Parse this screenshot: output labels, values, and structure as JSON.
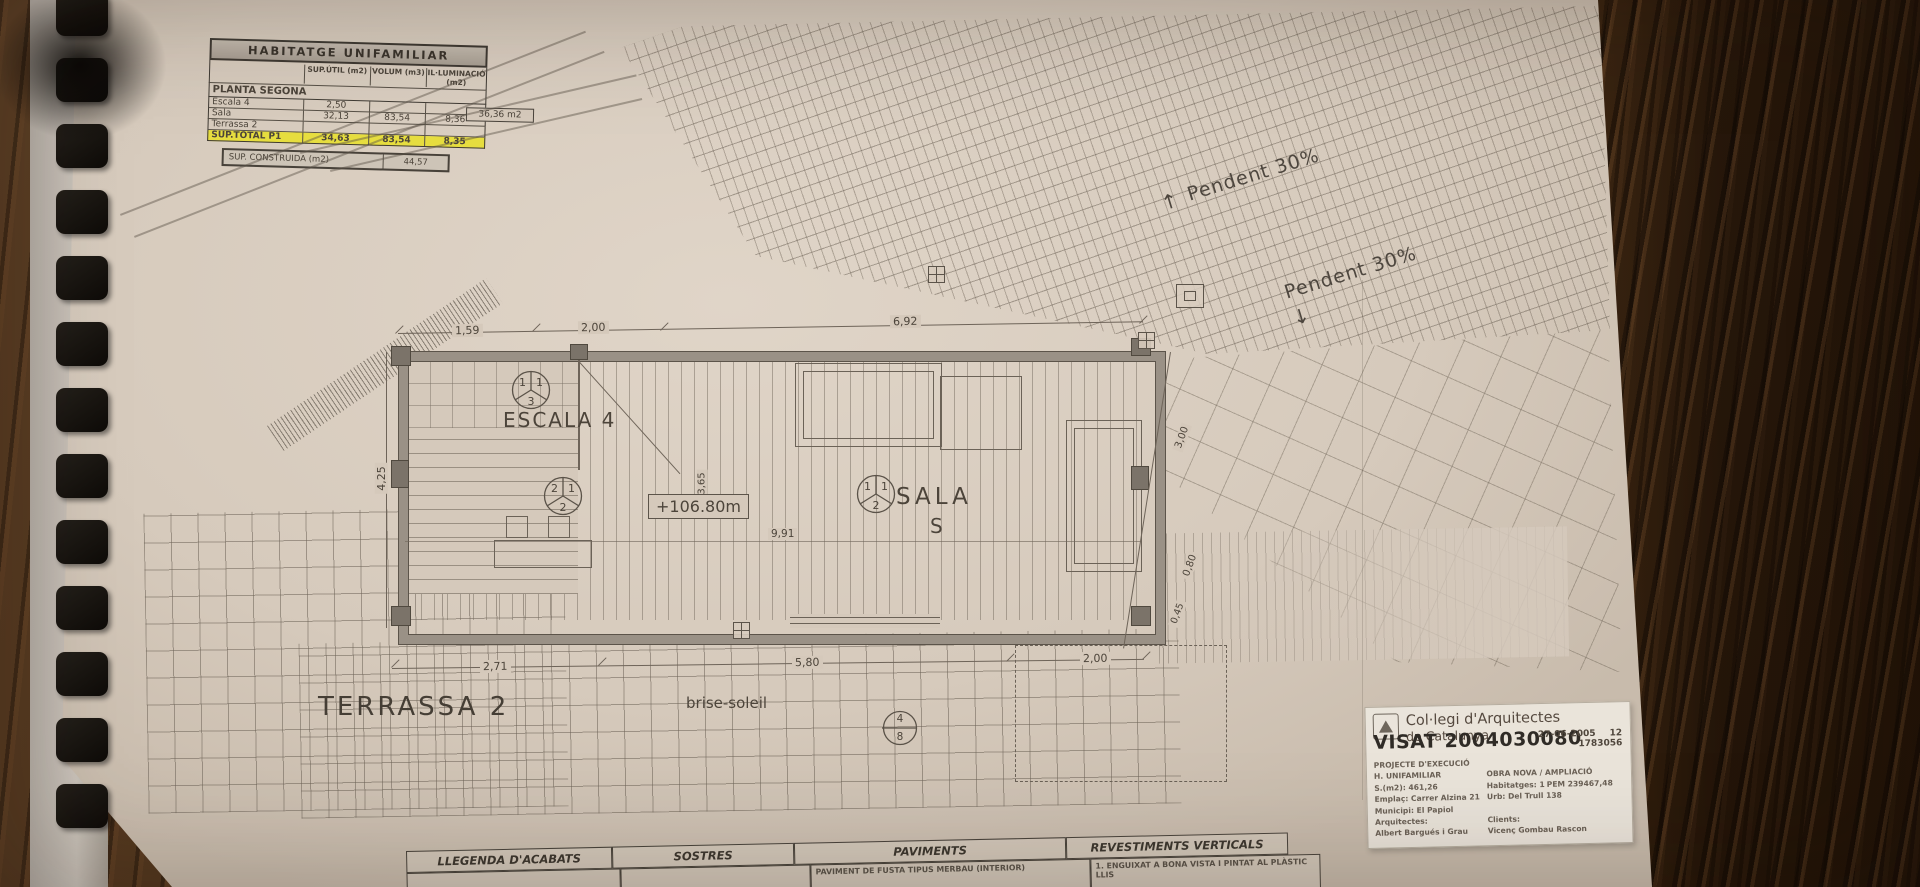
{
  "area_table": {
    "title": "HABITATGE UNIFAMILIAR",
    "col_headers": [
      "SUP.ÚTIL (m2)",
      "VOLUM (m3)",
      "IL·LUMINACIÓ (m2)"
    ],
    "section": "PLANTA SEGONA",
    "rows": [
      {
        "label": "Escala 4",
        "sup": "2,50",
        "vol": "",
        "il": ""
      },
      {
        "label": "Sala",
        "sup": "32,13",
        "vol": "83,54",
        "il": "8,36"
      },
      {
        "label": "Terrassa 2",
        "sup": "",
        "vol": "",
        "il": ""
      }
    ],
    "total": {
      "label": "SUP.TOTAL P1",
      "sup": "34,63",
      "vol": "83,54",
      "il": "8,35"
    },
    "side_note": "36,36 m2",
    "constructed": {
      "label": "SUP. CONSTRUIDA (m2)",
      "value": "44,57"
    }
  },
  "plan": {
    "labels": {
      "escala": "ESCALA 4",
      "sala": "SALA",
      "sala_letter": "S",
      "level": "+106.80m",
      "terrassa": "TERRASSA 2",
      "brise_soleil": "brise-soleil",
      "pendent_upper": "Pendent 30%",
      "pendent_lower": "Pendent 30%",
      "arrow_up": "↑",
      "arrow_down": "↓"
    },
    "stair_key": {
      "tl": "1",
      "tr": "1",
      "b": "3"
    },
    "level_key": {
      "tl": "2",
      "tr": "1",
      "b": "2"
    },
    "sala_key": {
      "tl": "1",
      "tr": "1",
      "b": "2"
    },
    "section_marker": {
      "top": "4",
      "bottom": "8"
    },
    "dimensions": {
      "top": [
        "1,59",
        "2,00",
        "6,92"
      ],
      "left": "4,25",
      "inner_width": "3,65",
      "inner_length": "9,91",
      "right": [
        "3,00",
        "0,80",
        "0,45"
      ],
      "bottom": [
        "2,71",
        "5,80",
        "2,00"
      ]
    }
  },
  "stamp": {
    "org_line1": "Col·legi d'Arquitectes",
    "org_line2": "de Catalunya",
    "visat": "VISAT 2004030080",
    "date": "27-06-2005",
    "page": "12",
    "ref": "1783056",
    "rows": [
      {
        "left": "PROJECTE D'EXECUCIÓ",
        "mid": "",
        "right": ""
      },
      {
        "left": "H. UNIFAMILIAR",
        "mid": "",
        "right": "OBRA NOVA / AMPLIACIÓ"
      },
      {
        "left": "S.(m2): 461,26",
        "mid": "Habitatges: 1",
        "right": "PEM  239467,48"
      },
      {
        "left": "Emplaç: Carrer Alzina 21",
        "mid": "",
        "right": "Urb: Del Trull 138"
      },
      {
        "left": "Municipi: El Papiol",
        "mid": "",
        "right": ""
      },
      {
        "left": "Arquitectes:",
        "mid": "",
        "right": "Clients:"
      },
      {
        "left": "  Albert Bargués i Grau",
        "mid": "",
        "right": "Vicenç Gombau Rascon"
      }
    ]
  },
  "legend": {
    "headers": [
      "LLEGENDA D'ACABATS",
      "SOSTRES",
      "PAVIMENTS",
      "REVESTIMENTS VERTICALS"
    ],
    "paviments_item": "PAVIMENT DE FUSTA TIPUS MERBAU (INTERIOR)",
    "revestiments_item": "1. ENGUIXAT A BONA VISTA I PINTAT AL PLÀSTIC LLIS"
  },
  "colors": {
    "paper": "#d8ccbe",
    "ink": "#4c443a",
    "highlight_yellow": "#e6dd3f",
    "wood": "#46301c",
    "binding": "#17130e"
  }
}
